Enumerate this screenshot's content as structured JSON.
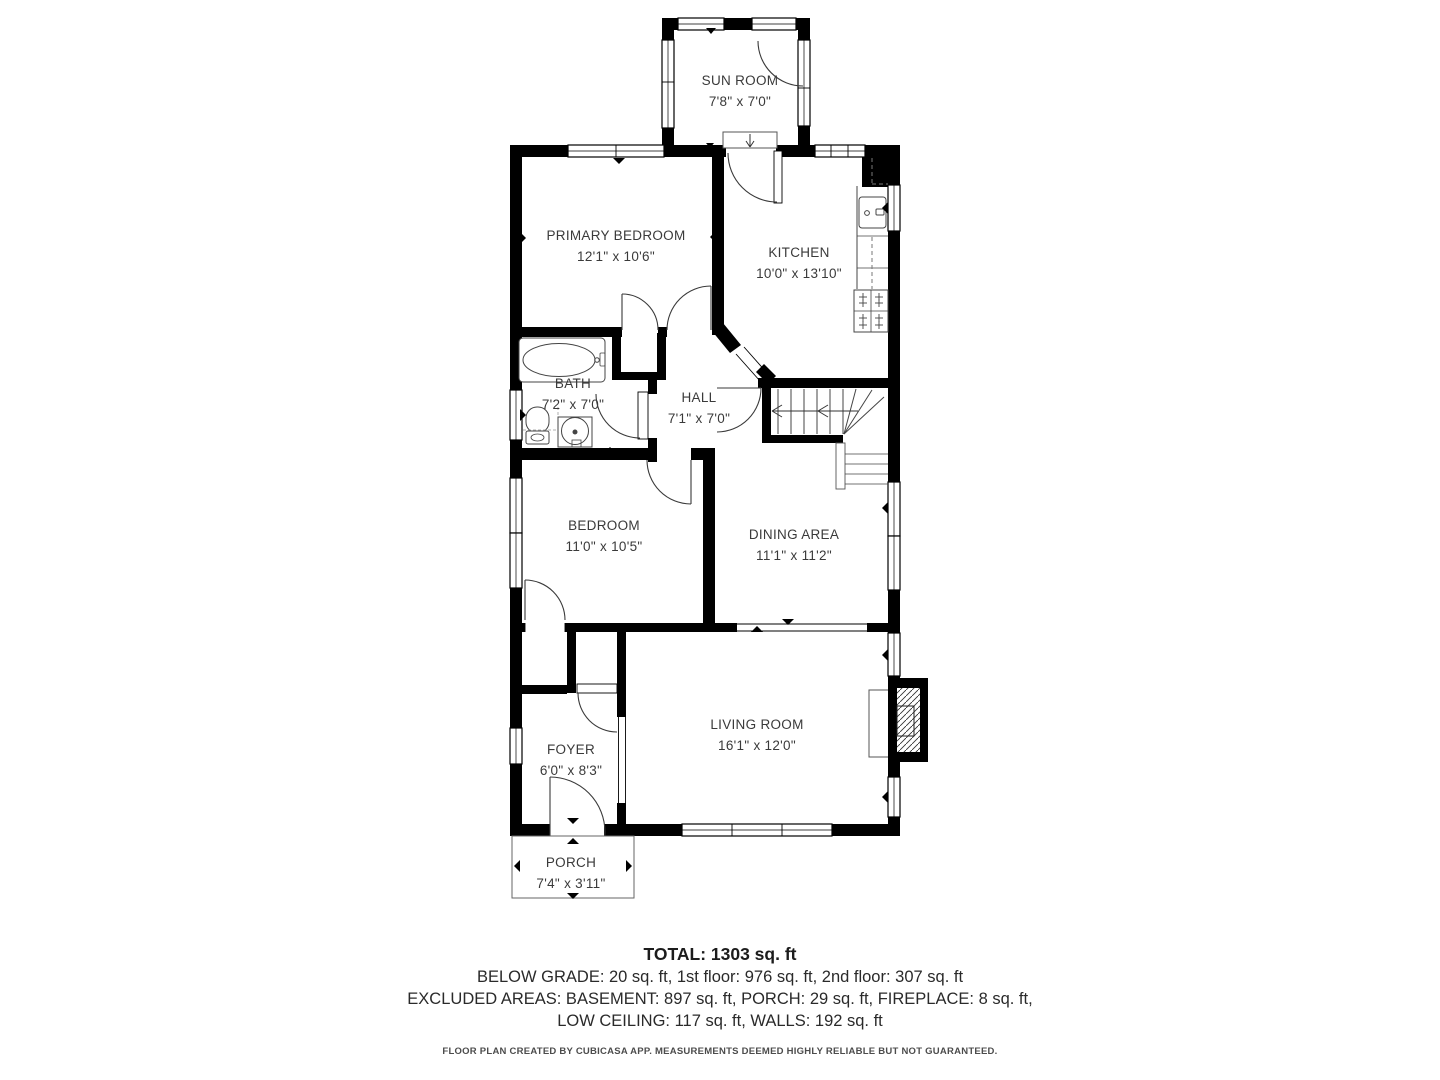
{
  "rooms": [
    {
      "name": "SUN ROOM",
      "dims": "7'8\" x 7'0\""
    },
    {
      "name": "PRIMARY BEDROOM",
      "dims": "12'1\" x 10'6\""
    },
    {
      "name": "KITCHEN",
      "dims": "10'0\" x 13'10\""
    },
    {
      "name": "BATH",
      "dims": "7'2\" x 7'0\""
    },
    {
      "name": "HALL",
      "dims": "7'1\" x 7'0\""
    },
    {
      "name": "BEDROOM",
      "dims": "11'0\" x 10'5\""
    },
    {
      "name": "DINING AREA",
      "dims": "11'1\" x 11'2\""
    },
    {
      "name": "LIVING ROOM",
      "dims": "16'1\" x 12'0\""
    },
    {
      "name": "FOYER",
      "dims": "6'0\" x 8'3\""
    },
    {
      "name": "PORCH",
      "dims": "7'4\" x 3'11\""
    }
  ],
  "summary": {
    "total": "TOTAL: 1303 sq. ft",
    "line1": "BELOW GRADE: 20 sq. ft, 1st floor: 976 sq. ft, 2nd floor: 307 sq. ft",
    "line2": "EXCLUDED AREAS: BASEMENT: 897 sq. ft, PORCH: 29 sq. ft, FIREPLACE: 8 sq. ft,",
    "line3": "LOW CEILING: 117 sq. ft, WALLS: 192 sq. ft",
    "disclaimer": "FLOOR PLAN CREATED BY CUBICASA APP. MEASUREMENTS DEEMED HIGHLY RELIABLE BUT NOT GUARANTEED."
  },
  "colors": {
    "wall": "#000000",
    "label_text": "#3a3a3a",
    "summary_text": "#232323"
  }
}
